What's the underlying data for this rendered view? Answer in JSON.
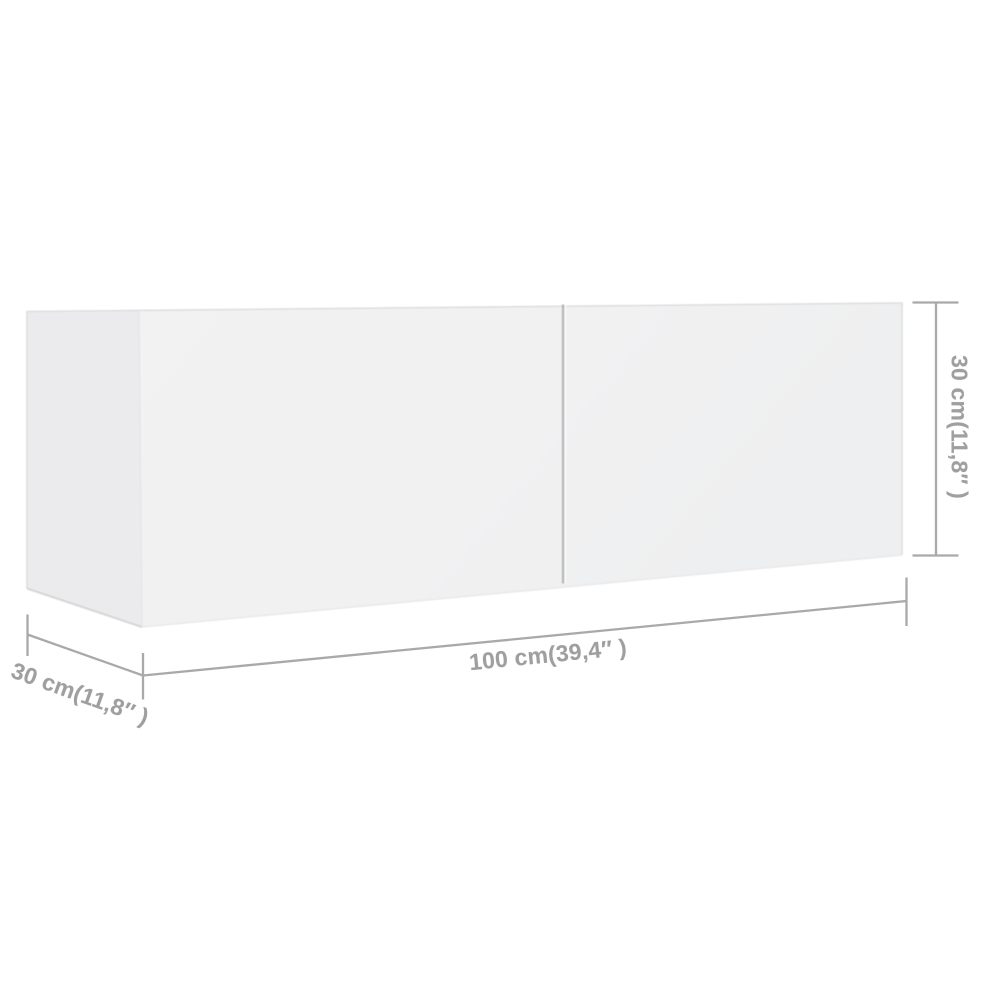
{
  "dimensions": {
    "width": {
      "label": "100 cm(39,4″ )",
      "cm": "100",
      "inches": "39,4"
    },
    "height": {
      "label": "30 cm(11,8″ )",
      "cm": "30",
      "inches": "11,8"
    },
    "depth": {
      "label": "30 cm(11,8″ )",
      "cm": "30",
      "inches": "11,8"
    }
  },
  "colors": {
    "background": "#ffffff",
    "cabinet_front_face": "#f1f1f2",
    "cabinet_side_face": "#ebebed",
    "cabinet_edge": "#d8d8d8",
    "door_divider": "#b4b4b4",
    "dimension_line": "#a9a9a9",
    "dimension_text": "#9f9f9f"
  }
}
